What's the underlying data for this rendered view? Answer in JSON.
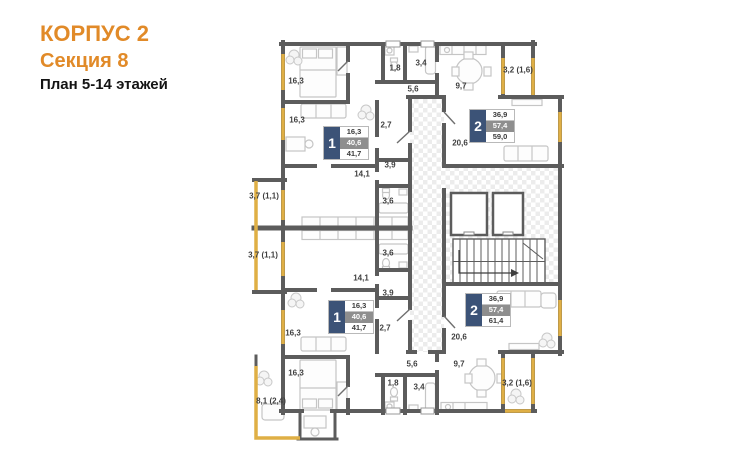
{
  "header": {
    "building": "КОРПУС 2",
    "section": "Секция 8",
    "floors": "План 5-14 этажей"
  },
  "colors": {
    "title_orange": "#E18A28",
    "wall_gray": "#5C5C5C",
    "balcony_gold": "#DFAF45",
    "apartment_badge_blue": "#3C5377",
    "area_row_gray": "#8E8E8E"
  },
  "apartments": [
    {
      "number": "1",
      "position": "top",
      "living_area": "16,3",
      "floor_area": "40,6",
      "total_area": "41,7"
    },
    {
      "number": "2",
      "position": "top",
      "living_area": "36,9",
      "floor_area": "57,4",
      "total_area": "59,0"
    },
    {
      "number": "1",
      "position": "bottom",
      "living_area": "16,3",
      "floor_area": "40,6",
      "total_area": "41,7"
    },
    {
      "number": "2",
      "position": "bottom",
      "living_area": "36,9",
      "floor_area": "57,4",
      "total_area": "61,4"
    }
  ],
  "rooms": [
    {
      "name": "bedroom-top",
      "area": "16,3"
    },
    {
      "name": "bathroom-small-top",
      "area": "1,8"
    },
    {
      "name": "bathroom-top",
      "area": "3,4"
    },
    {
      "name": "hall-top",
      "area": "5,6"
    },
    {
      "name": "kitchen-top",
      "area": "9,7"
    },
    {
      "name": "balcony-top-right",
      "area": "3,2 (1,6)"
    },
    {
      "name": "living-top",
      "area": "16,3"
    },
    {
      "name": "hallway-top",
      "area": "2,7"
    },
    {
      "name": "living-kitchen-top",
      "area": "20,6"
    },
    {
      "name": "corridor-top",
      "area": "3,9"
    },
    {
      "name": "kitchen-apt1-top",
      "area": "14,1"
    },
    {
      "name": "bathroom-apt1-top",
      "area": "3,6"
    },
    {
      "name": "balcony-left-upper",
      "area": "3,7 (1,1)"
    },
    {
      "name": "balcony-left-lower",
      "area": "3,7 (1,1)"
    },
    {
      "name": "bathroom-apt1-bottom",
      "area": "3,6"
    },
    {
      "name": "kitchen-apt1-bottom",
      "area": "14,1"
    },
    {
      "name": "corridor-bottom",
      "area": "3,9"
    },
    {
      "name": "living-bottom",
      "area": "16,3"
    },
    {
      "name": "hallway-bottom",
      "area": "2,7"
    },
    {
      "name": "living-kitchen-bottom",
      "area": "20,6"
    },
    {
      "name": "bedroom-bottom",
      "area": "16,3"
    },
    {
      "name": "bathroom-small-bottom",
      "area": "1,8"
    },
    {
      "name": "bathroom-bottom",
      "area": "3,4"
    },
    {
      "name": "hall-bottom",
      "area": "5,6"
    },
    {
      "name": "kitchen-bottom",
      "area": "9,7"
    },
    {
      "name": "balcony-bottom-left",
      "area": "8,1 (2,4)"
    },
    {
      "name": "balcony-bottom-right",
      "area": "3,2 (1,6)"
    }
  ]
}
